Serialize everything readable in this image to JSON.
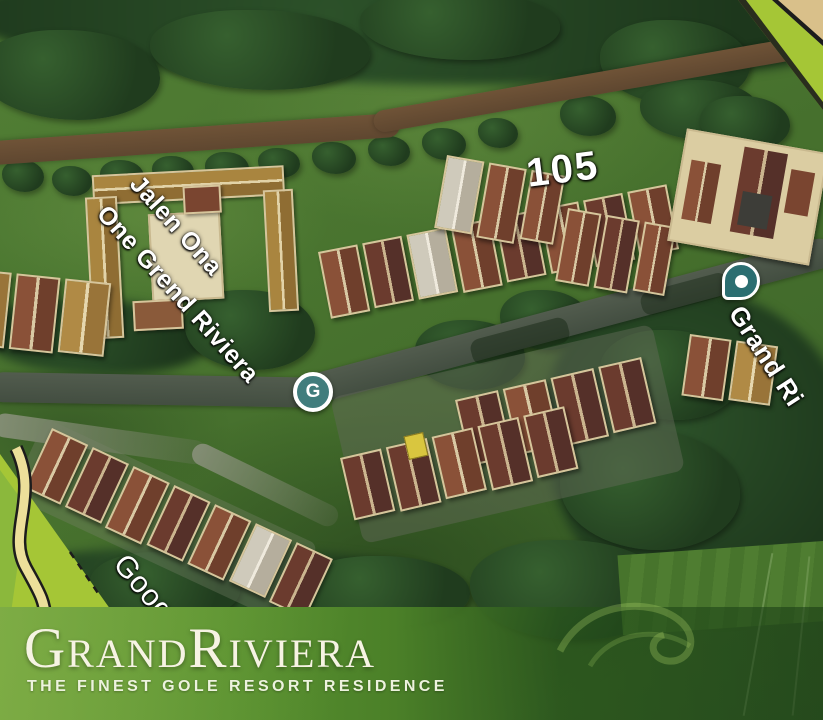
{
  "map": {
    "street_label": {
      "line1": "Jalen Ona",
      "line2": "One Grend Riviera"
    },
    "street_label_right": "Grand Ri",
    "lot_label": "105",
    "watermark": "Goog",
    "g_marker": {
      "letter": "G",
      "color": "#417d7d"
    },
    "place_pin_color": "#2b6e71",
    "road_color": "#4b5449",
    "grass_color": "#46702d"
  },
  "banner": {
    "brand": "GrandRiviera",
    "tagline": "THE FINEST GOLE RESORT RESIDENCE",
    "green": "#55892f",
    "text_color": "#f6f3e3"
  }
}
